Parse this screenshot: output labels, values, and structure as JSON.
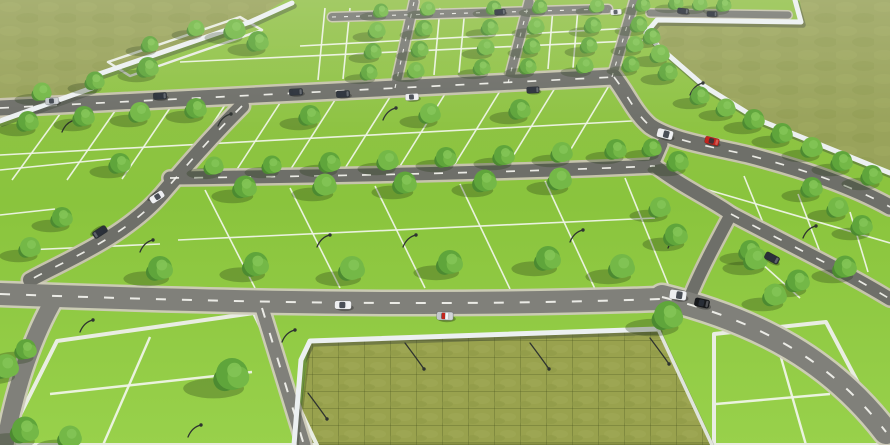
{
  "meta": {
    "title": "Plotted Land Development - 3D Aerial Render",
    "description": "3D aerial render of a residential plotted land development: bright green plots in a perspective grid divided by white lines, tree-lined grey roads with cars and curved street lamps, white compound boundary walls, a walled crop field at bottom centre, and open olive-green fields at the top left and top right."
  },
  "palette": {
    "grass": "#8CC63F",
    "grass_top": "#94C24C",
    "grass_bottom": "#98D14B",
    "olive_field": "#99A35B",
    "crop_field": "#99A24E",
    "road": "#6E6F69",
    "road_far": "#7A7B74",
    "road_near": "#80807A",
    "curb": "#C9C4B2",
    "curb_light": "#CFCBBA",
    "plot_line": "#EFF5E6",
    "dash": "#F4F4EF",
    "wall": "#ECF0F1",
    "wall_shadow": "rgba(60,68,55,0.42)",
    "tree_dark": "#4C8A31",
    "tree_mid": "#5FA53B",
    "tree_light": "#74B847",
    "tree_top": "#83C455",
    "shadow": "rgba(35,55,20,0.30)",
    "lamp": "#2E3330",
    "car_white": "#EDEEF0",
    "car_silver": "#C3C7CB",
    "car_navy": "#2A3038",
    "car_black": "#17191C",
    "car_red": "#C3251D"
  },
  "scene": {
    "fields": [
      {
        "name": "open-field-top-left",
        "tex": "olive",
        "pts": [
          [
            0,
            0
          ],
          [
            285,
            0
          ],
          [
            250,
            22
          ],
          [
            99,
            74
          ],
          [
            92,
            88
          ],
          [
            0,
            121
          ]
        ]
      },
      {
        "name": "open-field-top-right",
        "tex": "olive",
        "pts": [
          [
            800,
            0
          ],
          [
            890,
            0
          ],
          [
            890,
            170
          ],
          [
            759,
            120
          ],
          [
            704,
            86
          ],
          [
            656,
            45
          ],
          [
            646,
            33
          ],
          [
            657,
            21
          ],
          [
            802,
            24
          ]
        ]
      },
      {
        "name": "walled-crop-plot",
        "tex": "crop",
        "pts": [
          [
            303,
            400
          ],
          [
            310,
            341
          ],
          [
            658,
            329
          ],
          [
            712,
            445
          ],
          [
            297,
            445
          ]
        ]
      }
    ],
    "plot_outlines": [
      {
        "name": "corner-plot",
        "w": 2.5,
        "pts": [
          [
            108,
            62
          ],
          [
            240,
            17
          ],
          [
            262,
            30
          ],
          [
            130,
            76
          ]
        ]
      },
      {
        "name": "large-plot-bottom-left",
        "w": 4,
        "pts": [
          [
            57,
            341
          ],
          [
            254,
            313
          ],
          [
            317,
            445
          ],
          [
            5,
            445
          ]
        ]
      },
      {
        "name": "plot-bottom-right",
        "w": 4,
        "pts": [
          [
            714,
            334
          ],
          [
            826,
            322
          ],
          [
            884,
            432
          ],
          [
            890,
            445
          ],
          [
            714,
            445
          ]
        ]
      }
    ],
    "plot_lines": [
      [
        325,
        8,
        318,
        80
      ],
      [
        350,
        8,
        343,
        79
      ],
      [
        440,
        8,
        434,
        75
      ],
      [
        465,
        8,
        459,
        73
      ],
      [
        553,
        8,
        548,
        69
      ],
      [
        578,
        8,
        573,
        68
      ],
      [
        300,
        46,
        652,
        27
      ],
      [
        180,
        62,
        650,
        40
      ],
      [
        60,
        114,
        12,
        180
      ],
      [
        115,
        111,
        67,
        180
      ],
      [
        170,
        108,
        122,
        179
      ],
      [
        225,
        105,
        177,
        178
      ],
      [
        280,
        103,
        232,
        177
      ],
      [
        335,
        100,
        287,
        175
      ],
      [
        390,
        97,
        342,
        173
      ],
      [
        445,
        94,
        397,
        171
      ],
      [
        500,
        91,
        452,
        169
      ],
      [
        555,
        88,
        507,
        166
      ],
      [
        610,
        84,
        562,
        164
      ],
      [
        0,
        155,
        650,
        120
      ],
      [
        205,
        190,
        255,
        288
      ],
      [
        290,
        188,
        340,
        288
      ],
      [
        375,
        186,
        425,
        288
      ],
      [
        460,
        184,
        510,
        289
      ],
      [
        545,
        181,
        595,
        289
      ],
      [
        625,
        178,
        670,
        289
      ],
      [
        178,
        240,
        655,
        218
      ],
      [
        25,
        250,
        160,
        244
      ],
      [
        0,
        170,
        120,
        158
      ],
      [
        0,
        215,
        55,
        209
      ],
      [
        744,
        176,
        766,
        230
      ],
      [
        798,
        194,
        820,
        252
      ],
      [
        850,
        212,
        868,
        272
      ],
      [
        664,
        177,
        890,
        243
      ],
      [
        760,
        262,
        800,
        298
      ],
      [
        716,
        404,
        830,
        394
      ],
      [
        772,
        326,
        806,
        445
      ],
      [
        150,
        337,
        103,
        445
      ],
      [
        50,
        394,
        252,
        372
      ]
    ],
    "roads": [
      {
        "name": "road-top-strip",
        "d": "M 332,17 L 608,9",
        "w": 8,
        "tone": "far",
        "dash": true
      },
      {
        "name": "road-top-right",
        "d": "M 650,13 L 788,15",
        "w": 7,
        "tone": "far",
        "dash": false
      },
      {
        "name": "connector-road-1",
        "d": "M 395,88 L 414,2",
        "w": 9,
        "tone": "far",
        "dash": true
      },
      {
        "name": "connector-road-2",
        "d": "M 508,83 L 529,2",
        "w": 9,
        "tone": "far",
        "dash": true
      },
      {
        "name": "connector-road-3",
        "d": "M 612,77 L 634,2",
        "w": 9,
        "tone": "far",
        "dash": true
      },
      {
        "name": "main-road-upper",
        "d": "M 0,108 L 614,77",
        "w": 15,
        "tone": "mid",
        "dash": true
      },
      {
        "name": "main-road-middle",
        "d": "M 170,178 C 350,176 520,172 655,166",
        "w": 13,
        "tone": "mid",
        "dash": true
      },
      {
        "name": "middle-road-stub",
        "d": "M 652,167 L 662,144",
        "w": 11,
        "tone": "mid",
        "dash": false
      },
      {
        "name": "diagonal-road-left",
        "d": "M 242,106 C 212,136 186,166 162,194 C 124,238 62,262 30,280",
        "w": 14,
        "tone": "mid",
        "dash": true
      },
      {
        "name": "diagonal-road-right",
        "d": "M 614,77 C 628,95 634,112 650,126 C 672,141 710,146 748,155 C 806,170 852,186 890,207",
        "w": 15,
        "tone": "mid",
        "dash": true
      },
      {
        "name": "junction-road-upper",
        "d": "M 655,166 C 684,188 712,200 731,214",
        "w": 13,
        "tone": "mid",
        "dash": false
      },
      {
        "name": "junction-road-east",
        "d": "M 731,214 C 788,244 846,272 890,299",
        "w": 13,
        "tone": "mid",
        "dash": true
      },
      {
        "name": "junction-road-south",
        "d": "M 731,214 C 716,242 700,272 690,297",
        "w": 12,
        "tone": "mid",
        "dash": false
      },
      {
        "name": "main-road-lower",
        "d": "M 0,294 C 220,302 430,307 660,299",
        "w": 22,
        "tone": "near",
        "dash": true
      },
      {
        "name": "road-bottom-right",
        "d": "M 662,297 C 762,322 832,362 886,432",
        "w": 24,
        "tone": "near",
        "dash": true
      },
      {
        "name": "road-bottom-left",
        "d": "M 55,298 C 35,332 15,385 5,445",
        "w": 17,
        "tone": "near",
        "dash": false
      },
      {
        "name": "road-beside-walled-plot",
        "d": "M 262,308 L 304,445",
        "w": 13,
        "tone": "near",
        "dash": true
      }
    ],
    "walls": [
      {
        "name": "boundary-wall-northwest",
        "thin": false,
        "pts": [
          [
            0,
            121
          ],
          [
            92,
            88
          ],
          [
            99,
            74
          ],
          [
            250,
            22
          ],
          [
            292,
            3
          ]
        ]
      },
      {
        "name": "boundary-wall-northeast",
        "thin": false,
        "pts": [
          [
            795,
            0
          ],
          [
            801,
            22
          ],
          [
            657,
            20
          ],
          [
            646,
            33
          ],
          [
            658,
            46
          ],
          [
            704,
            86
          ],
          [
            759,
            120
          ],
          [
            890,
            173
          ]
        ]
      },
      {
        "name": "walled-plot-wall",
        "thin": false,
        "pts": [
          [
            294,
            445
          ],
          [
            301,
            360
          ],
          [
            310,
            341
          ],
          [
            658,
            329
          ]
        ]
      },
      {
        "name": "walled-plot-east-kerb",
        "thin": true,
        "pts": [
          [
            658,
            329
          ],
          [
            712,
            445
          ]
        ]
      }
    ],
    "trees": [
      [
        42,
        96,
        9
      ],
      [
        95,
        85,
        9
      ],
      [
        148,
        72,
        10
      ],
      [
        235,
        34,
        10
      ],
      [
        258,
        46,
        10
      ],
      [
        150,
        48,
        8
      ],
      [
        196,
        32,
        8
      ],
      [
        28,
        126,
        10
      ],
      [
        84,
        121,
        10
      ],
      [
        140,
        117,
        10
      ],
      [
        196,
        113,
        10
      ],
      [
        310,
        120,
        10
      ],
      [
        430,
        118,
        10
      ],
      [
        520,
        114,
        10
      ],
      [
        381,
        14,
        7
      ],
      [
        377,
        34,
        8
      ],
      [
        373,
        55,
        8
      ],
      [
        369,
        76,
        8
      ],
      [
        428,
        12,
        7
      ],
      [
        424,
        32,
        8
      ],
      [
        420,
        53,
        8
      ],
      [
        416,
        74,
        8
      ],
      [
        494,
        11,
        7
      ],
      [
        490,
        31,
        8
      ],
      [
        486,
        51,
        8
      ],
      [
        482,
        71,
        8
      ],
      [
        540,
        10,
        7
      ],
      [
        536,
        30,
        8
      ],
      [
        532,
        50,
        8
      ],
      [
        528,
        70,
        8
      ],
      [
        597,
        9,
        7
      ],
      [
        593,
        29,
        8
      ],
      [
        589,
        49,
        8
      ],
      [
        585,
        69,
        8
      ],
      [
        643,
        8,
        7
      ],
      [
        639,
        28,
        8
      ],
      [
        635,
        48,
        8
      ],
      [
        631,
        68,
        8
      ],
      [
        676,
        6,
        7
      ],
      [
        700,
        7,
        7
      ],
      [
        724,
        8,
        7
      ],
      [
        652,
        40,
        8
      ],
      [
        660,
        58,
        9
      ],
      [
        668,
        76,
        9
      ],
      [
        700,
        100,
        9
      ],
      [
        726,
        112,
        9
      ],
      [
        754,
        124,
        10
      ],
      [
        782,
        138,
        10
      ],
      [
        812,
        152,
        10
      ],
      [
        842,
        166,
        10
      ],
      [
        872,
        180,
        10
      ],
      [
        214,
        170,
        9
      ],
      [
        272,
        169,
        9
      ],
      [
        330,
        167,
        10
      ],
      [
        388,
        165,
        10
      ],
      [
        446,
        162,
        10
      ],
      [
        504,
        160,
        10
      ],
      [
        562,
        157,
        10
      ],
      [
        616,
        154,
        10
      ],
      [
        245,
        192,
        11
      ],
      [
        325,
        190,
        11
      ],
      [
        405,
        188,
        11
      ],
      [
        485,
        186,
        11
      ],
      [
        560,
        184,
        11
      ],
      [
        160,
        274,
        12
      ],
      [
        256,
        270,
        12
      ],
      [
        352,
        274,
        12
      ],
      [
        450,
        268,
        12
      ],
      [
        548,
        264,
        12
      ],
      [
        622,
        272,
        12
      ],
      [
        120,
        168,
        10
      ],
      [
        62,
        222,
        10
      ],
      [
        30,
        252,
        10
      ],
      [
        652,
        152,
        9
      ],
      [
        678,
        166,
        10
      ],
      [
        660,
        212,
        10
      ],
      [
        676,
        240,
        11
      ],
      [
        812,
        192,
        10
      ],
      [
        838,
        212,
        10
      ],
      [
        862,
        230,
        10
      ],
      [
        750,
        255,
        10
      ],
      [
        756,
        264,
        11
      ],
      [
        798,
        286,
        11
      ],
      [
        845,
        272,
        11
      ],
      [
        775,
        300,
        11
      ],
      [
        668,
        322,
        14
      ],
      [
        232,
        382,
        16
      ],
      [
        6,
        372,
        12
      ],
      [
        26,
        354,
        10
      ],
      [
        25,
        436,
        13
      ],
      [
        70,
        442,
        11
      ]
    ],
    "lamps": [
      [
        62,
        132,
        1,
        0
      ],
      [
        218,
        126,
        1,
        0
      ],
      [
        383,
        120,
        1,
        0
      ],
      [
        140,
        252,
        1,
        0
      ],
      [
        317,
        247,
        1,
        0
      ],
      [
        403,
        247,
        1,
        0
      ],
      [
        570,
        242,
        1,
        0
      ],
      [
        690,
        95,
        1,
        0
      ],
      [
        668,
        248,
        1,
        0
      ],
      [
        803,
        238,
        1,
        0
      ],
      [
        80,
        332,
        1,
        0
      ],
      [
        282,
        342,
        1,
        0
      ],
      [
        188,
        437,
        1,
        0
      ],
      [
        405,
        343,
        1,
        1
      ],
      [
        530,
        343,
        1,
        1
      ],
      [
        650,
        338,
        1,
        1
      ],
      [
        308,
        393,
        1,
        1
      ]
    ],
    "cars": [
      {
        "x": 500,
        "y": 12,
        "rot": -4,
        "s": 0.7,
        "color": "navy",
        "kind": "sedan"
      },
      {
        "x": 616,
        "y": 12,
        "rot": -4,
        "s": 0.7,
        "color": "white",
        "kind": "sedan"
      },
      {
        "x": 683,
        "y": 11,
        "rot": 6,
        "s": 0.7,
        "color": "navy",
        "kind": "sedan"
      },
      {
        "x": 712,
        "y": 14,
        "rot": 2,
        "s": 0.65,
        "color": "navy",
        "kind": "sedan"
      },
      {
        "x": 52,
        "y": 101,
        "rot": -3,
        "s": 0.85,
        "color": "silver",
        "kind": "sedan"
      },
      {
        "x": 160,
        "y": 96,
        "rot": -3,
        "s": 0.85,
        "color": "navy",
        "kind": "sedan"
      },
      {
        "x": 296,
        "y": 92,
        "rot": -3,
        "s": 0.85,
        "color": "navy",
        "kind": "sedan"
      },
      {
        "x": 343,
        "y": 94,
        "rot": -3,
        "s": 0.85,
        "color": "navy",
        "kind": "sedan"
      },
      {
        "x": 412,
        "y": 97,
        "rot": -3,
        "s": 0.85,
        "color": "white",
        "kind": "sedan"
      },
      {
        "x": 533,
        "y": 90,
        "rot": -3,
        "s": 0.8,
        "color": "navy",
        "kind": "sedan"
      },
      {
        "x": 157,
        "y": 197,
        "rot": 147,
        "s": 0.95,
        "color": "white",
        "kind": "sedan"
      },
      {
        "x": 100,
        "y": 232,
        "rot": 147,
        "s": 0.95,
        "color": "navy",
        "kind": "sedan"
      },
      {
        "x": 665,
        "y": 134,
        "rot": 14,
        "s": 0.95,
        "color": "white",
        "kind": "van"
      },
      {
        "x": 712,
        "y": 141,
        "rot": 14,
        "s": 0.9,
        "color": "red",
        "kind": "sedan"
      },
      {
        "x": 343,
        "y": 305,
        "rot": 1,
        "s": 1.05,
        "color": "white",
        "kind": "sedan"
      },
      {
        "x": 445,
        "y": 316,
        "rot": 2,
        "s": 1.05,
        "color": "silver",
        "kind": "taxi"
      },
      {
        "x": 678,
        "y": 295,
        "rot": 8,
        "s": 1.0,
        "color": "white",
        "kind": "van"
      },
      {
        "x": 702,
        "y": 303,
        "rot": 12,
        "s": 1.0,
        "color": "black",
        "kind": "suv"
      },
      {
        "x": 772,
        "y": 258,
        "rot": 28,
        "s": 0.95,
        "color": "navy",
        "kind": "sedan"
      }
    ]
  }
}
